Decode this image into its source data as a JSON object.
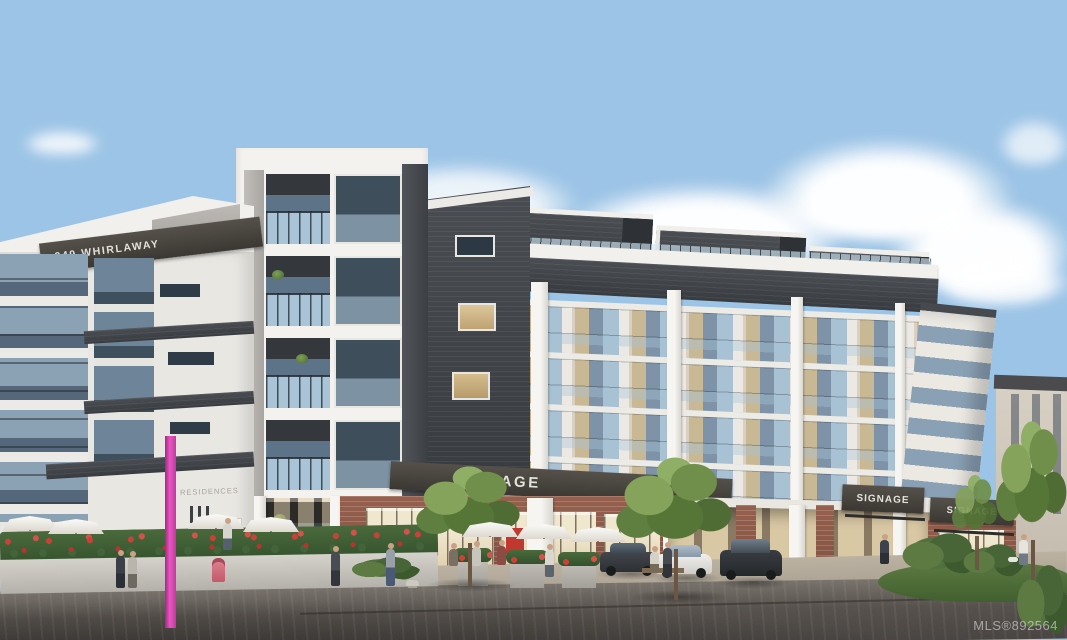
{
  "scene": {
    "title": "949 Whirlaway exterior rendering",
    "description": "Architectural rendering of a six-storey mixed-use condo building with white concrete frames, charcoal cladding and blue-grey panels, ground-floor retail with brick piers and SIGNAGE placeholder fascia bands, street plaza with patio umbrellas, planters, trees, pedestrians and parked cars under a blue sky with cumulus clouds."
  },
  "building": {
    "name_sign": "949 WHIRLAWAY",
    "residences_sign": "RESIDENCES",
    "retail_signs": [
      "SIGNAGE",
      "SIGNAGE",
      "SIGNAGE"
    ]
  },
  "watermark": {
    "label": "MLS®892564"
  },
  "palette": {
    "sky_top": "#3f7fc4",
    "sky_horizon": "#badcf3",
    "cloud": "#ffffff",
    "facade_white": "#efeeea",
    "cladding_charcoal": "#3f4347",
    "panel_blue_gray": "#7e93a7",
    "balcony_glass": "#a9c2d3",
    "window_glass_dark": "#3f4e5b",
    "window_warm": "#c9b894",
    "brick": "#8d5a49",
    "storefront_glass": "#e3d5b4",
    "signage_band": "#45423c",
    "tree_green": "#6f8f4a",
    "hedge_green": "#42603a",
    "flower_red": "#c23c35",
    "asphalt": "#57524d",
    "sidewalk_concrete": "#b3a99a",
    "pole_pink": "#d63ba4",
    "hydrant_pink": "#d96a74",
    "car_dark": "#2f3336",
    "car_white": "#e9e8e4",
    "red_store_sign": "#c03830",
    "watermark_color": "rgba(238,238,238,0.55)"
  }
}
